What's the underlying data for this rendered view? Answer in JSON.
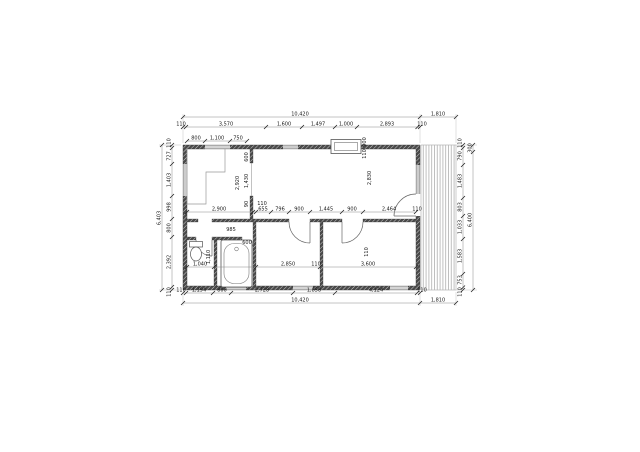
{
  "drawing": {
    "kind": "architectural floor plan",
    "total_width_label": "10,420",
    "terrace_width_label": "1,810",
    "total_height_left_label": "6,403",
    "total_height_right_label": "6,400"
  },
  "colors": {
    "wall": "#4a4a4a",
    "wall_hatch": "#cfcfcf",
    "thin_line": "#555555",
    "fixture_line": "#777777",
    "deck_line": "#b0b0b0",
    "dim_line": "#888888",
    "dim_text": "#1a1a1a"
  },
  "plan_elements": [
    "outer-wall",
    "terrace-deck",
    "kitchen-counter",
    "bathtub",
    "toilet",
    "window",
    "door-swing",
    "chimney-window-frame"
  ],
  "dim_chains": [
    {
      "id": "top-overall",
      "axis": "x",
      "at": 117,
      "ticks": [
        183,
        420,
        456
      ],
      "labels": [
        {
          "t": "10,420",
          "p": 300
        },
        {
          "t": "1,810",
          "p": 438
        }
      ]
    },
    {
      "id": "top-chain",
      "axis": "x",
      "at": 127,
      "ticks": [
        183,
        186,
        266,
        302,
        335,
        357,
        417.5,
        420
      ],
      "labels": [
        {
          "t": "110",
          "p": 181
        },
        {
          "t": "3,570",
          "p": 226
        },
        {
          "t": "1,600",
          "p": 284
        },
        {
          "t": "1,497",
          "p": 318
        },
        {
          "t": "1,000",
          "p": 346
        },
        {
          "t": "2,893",
          "p": 387
        },
        {
          "t": "110",
          "p": 422
        }
      ]
    },
    {
      "id": "left-outer",
      "axis": "y",
      "at": 162,
      "ticks": [
        145,
        290
      ],
      "labels": [
        {
          "t": "6,403",
          "p": 218
        }
      ]
    },
    {
      "id": "left-chain",
      "axis": "y",
      "at": 172,
      "ticks": [
        145,
        148,
        164,
        196,
        219,
        237,
        287,
        290
      ],
      "labels": [
        {
          "t": "110",
          "p": 143
        },
        {
          "t": "727",
          "p": 156
        },
        {
          "t": "1,403",
          "p": 180
        },
        {
          "t": "998",
          "p": 207
        },
        {
          "t": "800",
          "p": 228
        },
        {
          "t": "2,392",
          "p": 262
        },
        {
          "t": "110",
          "p": 292
        }
      ]
    },
    {
      "id": "right-chain",
      "axis": "y",
      "at": 463,
      "ticks": [
        145,
        148,
        165,
        198,
        216,
        239,
        274,
        287.5,
        290
      ],
      "labels": [
        {
          "t": "110",
          "p": 143
        },
        {
          "t": "790",
          "p": 156
        },
        {
          "t": "1,483",
          "p": 181
        },
        {
          "t": "803",
          "p": 207
        },
        {
          "t": "1,033",
          "p": 227
        },
        {
          "t": "1,583",
          "p": 256
        },
        {
          "t": "753",
          "p": 280
        },
        {
          "t": "110",
          "p": 292
        }
      ]
    },
    {
      "id": "right-outer",
      "axis": "y",
      "at": 473,
      "ticks": [
        145,
        152,
        290
      ],
      "labels": [
        {
          "t": "300",
          "p": 148
        },
        {
          "t": "6,400",
          "p": 220
        }
      ]
    },
    {
      "id": "bottom-chain",
      "axis": "x",
      "at": 293,
      "ticks": [
        183,
        186,
        213,
        231,
        293,
        335,
        417,
        420
      ],
      "labels": [
        {
          "t": "110",
          "p": 181
        },
        {
          "t": "1,194",
          "p": 199
        },
        {
          "t": "800",
          "p": 222
        },
        {
          "t": "2,728",
          "p": 262
        },
        {
          "t": "1,858",
          "p": 314
        },
        {
          "t": "4,124",
          "p": 376
        },
        {
          "t": "110",
          "p": 422
        }
      ]
    },
    {
      "id": "bottom-overall",
      "axis": "x",
      "at": 303,
      "ticks": [
        183,
        420,
        456
      ],
      "labels": [
        {
          "t": "10,420",
          "p": 300
        },
        {
          "t": "1,810",
          "p": 438
        }
      ]
    },
    {
      "id": "inner-top-left",
      "axis": "x",
      "at": 141,
      "ticks": [
        187,
        205,
        230,
        247
      ],
      "labels": [
        {
          "t": "800",
          "p": 196
        },
        {
          "t": "1,100",
          "p": 217
        },
        {
          "t": "750",
          "p": 238
        }
      ]
    },
    {
      "id": "inner-mid",
      "axis": "x",
      "at": 212,
      "ticks": [
        187,
        253,
        256,
        271,
        289,
        310,
        342,
        363,
        416
      ],
      "labels": [
        {
          "t": "2,900",
          "p": 219
        },
        {
          "t": "655",
          "p": 263
        },
        {
          "t": "796",
          "p": 280
        },
        {
          "t": "900",
          "p": 299
        },
        {
          "t": "1,445",
          "p": 326
        },
        {
          "t": "900",
          "p": 352
        },
        {
          "t": "2,464",
          "p": 389
        },
        {
          "t": "110",
          "p": 417
        }
      ]
    },
    {
      "id": "inner-low",
      "axis": "x",
      "at": 267,
      "ticks": [
        187,
        214,
        256,
        320,
        416
      ],
      "labels": [
        {
          "t": "1,040",
          "p": 200
        },
        {
          "t": "2,850",
          "p": 288
        },
        {
          "t": "110",
          "p": 316
        },
        {
          "t": "3,600",
          "p": 368
        }
      ]
    }
  ],
  "free_labels": [
    {
      "t": "2,920",
      "x": 239,
      "y": 183,
      "v": 1
    },
    {
      "t": "600",
      "x": 248,
      "y": 157,
      "v": 1
    },
    {
      "t": "1,430",
      "x": 248,
      "y": 181,
      "v": 1
    },
    {
      "t": "90",
      "x": 248,
      "y": 204,
      "v": 1
    },
    {
      "t": "110",
      "x": 262,
      "y": 205,
      "v": 0
    },
    {
      "t": "2,830",
      "x": 371,
      "y": 178,
      "v": 1
    },
    {
      "t": "900",
      "x": 366,
      "y": 142,
      "v": 1
    },
    {
      "t": "110",
      "x": 366,
      "y": 154,
      "v": 1
    },
    {
      "t": "985",
      "x": 231,
      "y": 231,
      "v": 0
    },
    {
      "t": "600",
      "x": 247,
      "y": 244,
      "v": 0
    },
    {
      "t": "1,110",
      "x": 210,
      "y": 257,
      "v": 1
    },
    {
      "t": "110",
      "x": 368,
      "y": 252,
      "v": 1
    }
  ]
}
